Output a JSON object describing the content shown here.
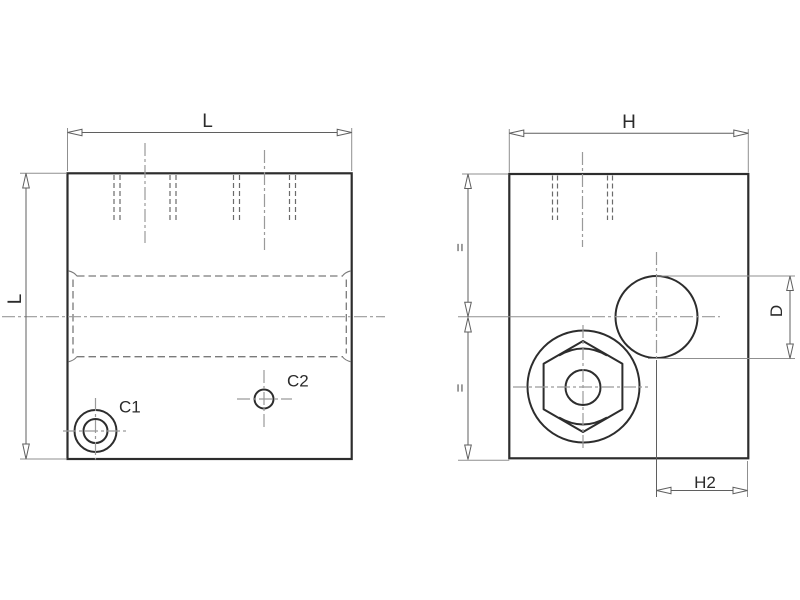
{
  "drawing": {
    "type": "technical-drawing-2-views",
    "views": {
      "front": {
        "width_label": "L",
        "height_label": "L",
        "port1_label": "C1",
        "port2_label": "C2"
      },
      "side": {
        "width_label": "H",
        "offset_label": "H2",
        "diameter_label": "D",
        "equal_top_label": "=",
        "equal_bottom_label": "="
      }
    },
    "colors": {
      "background": "#ffffff",
      "outline": "#2d2d2d",
      "dimension_line": "#5f5f5f",
      "extension_line": "#8f8f8f",
      "centerline": "#9a9a9a",
      "hidden_line": "#6b6b6b",
      "label_text": "#2b2b2b"
    }
  }
}
